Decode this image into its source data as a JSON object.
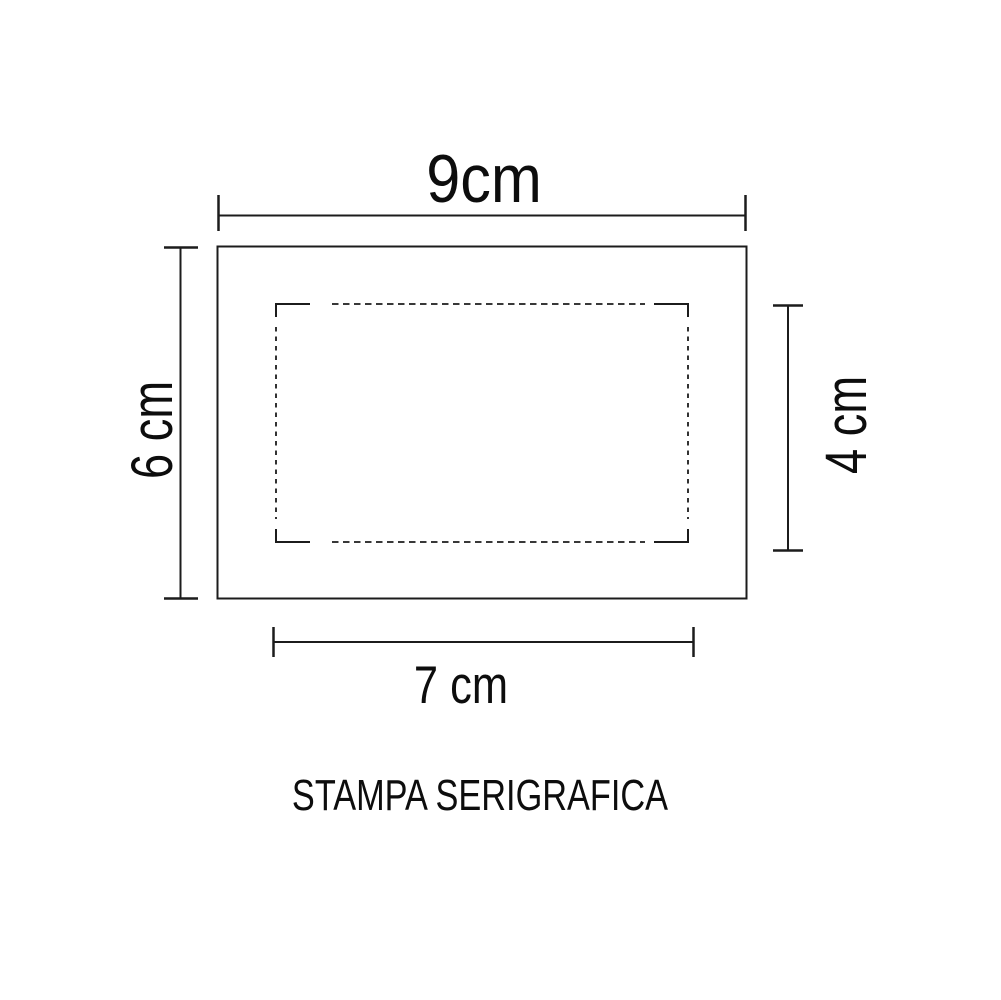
{
  "page": {
    "background": "#ffffff",
    "line_color": "#1c1c1c",
    "text_color": "#0d0d0d"
  },
  "drawing": {
    "caption": "STAMPA SERIGRAFICA",
    "outer_rect": {
      "width_label": "9cm",
      "height_label": "6 cm",
      "width_cm": 9,
      "height_cm": 6,
      "border_style": "solid"
    },
    "print_area": {
      "width_label": "7 cm",
      "height_label": "4 cm",
      "width_cm": 7,
      "height_cm": 4,
      "border_style": "dashed-with-solid-corner-brackets"
    }
  }
}
